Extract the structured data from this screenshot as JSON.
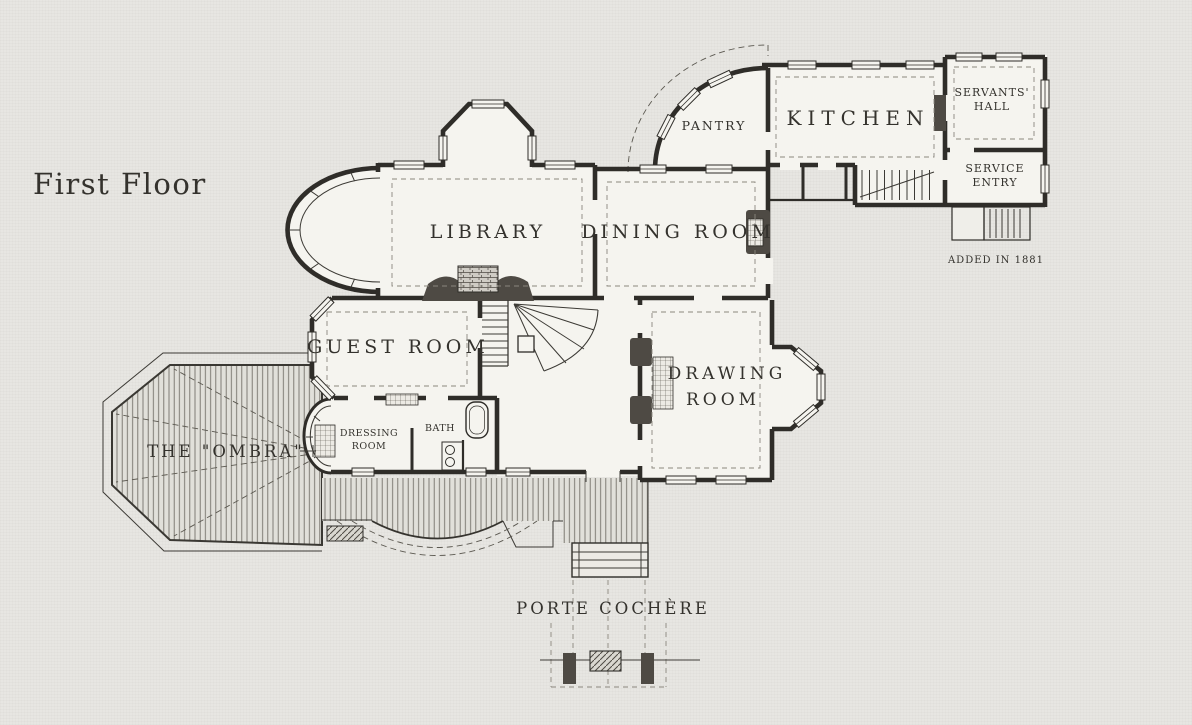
{
  "page": {
    "title": "First Floor",
    "paper_color": "#e7e6e2",
    "ink_color": "#2f2d29",
    "room_fill": "#f5f4ef"
  },
  "labels": {
    "library": "LIBRARY",
    "dining_room": "DINING  ROOM",
    "kitchen": "KITCHEN",
    "pantry": "PANTRY",
    "servants_hall": {
      "line1": "SERVANTS'",
      "line2": "HALL"
    },
    "service_entry": {
      "line1": "SERVICE",
      "line2": "ENTRY"
    },
    "guest_room": "GUEST  ROOM",
    "drawing_room": {
      "line1": "DRAWING",
      "line2": "ROOM"
    },
    "ombra": "THE  \"OMBRA\"",
    "dressing_room": {
      "line1": "DRESSING",
      "line2": "ROOM"
    },
    "bath": "BATH",
    "porte_cochere": "PORTE  COCHÈRE",
    "annotation_added": "ADDED IN 1881"
  }
}
